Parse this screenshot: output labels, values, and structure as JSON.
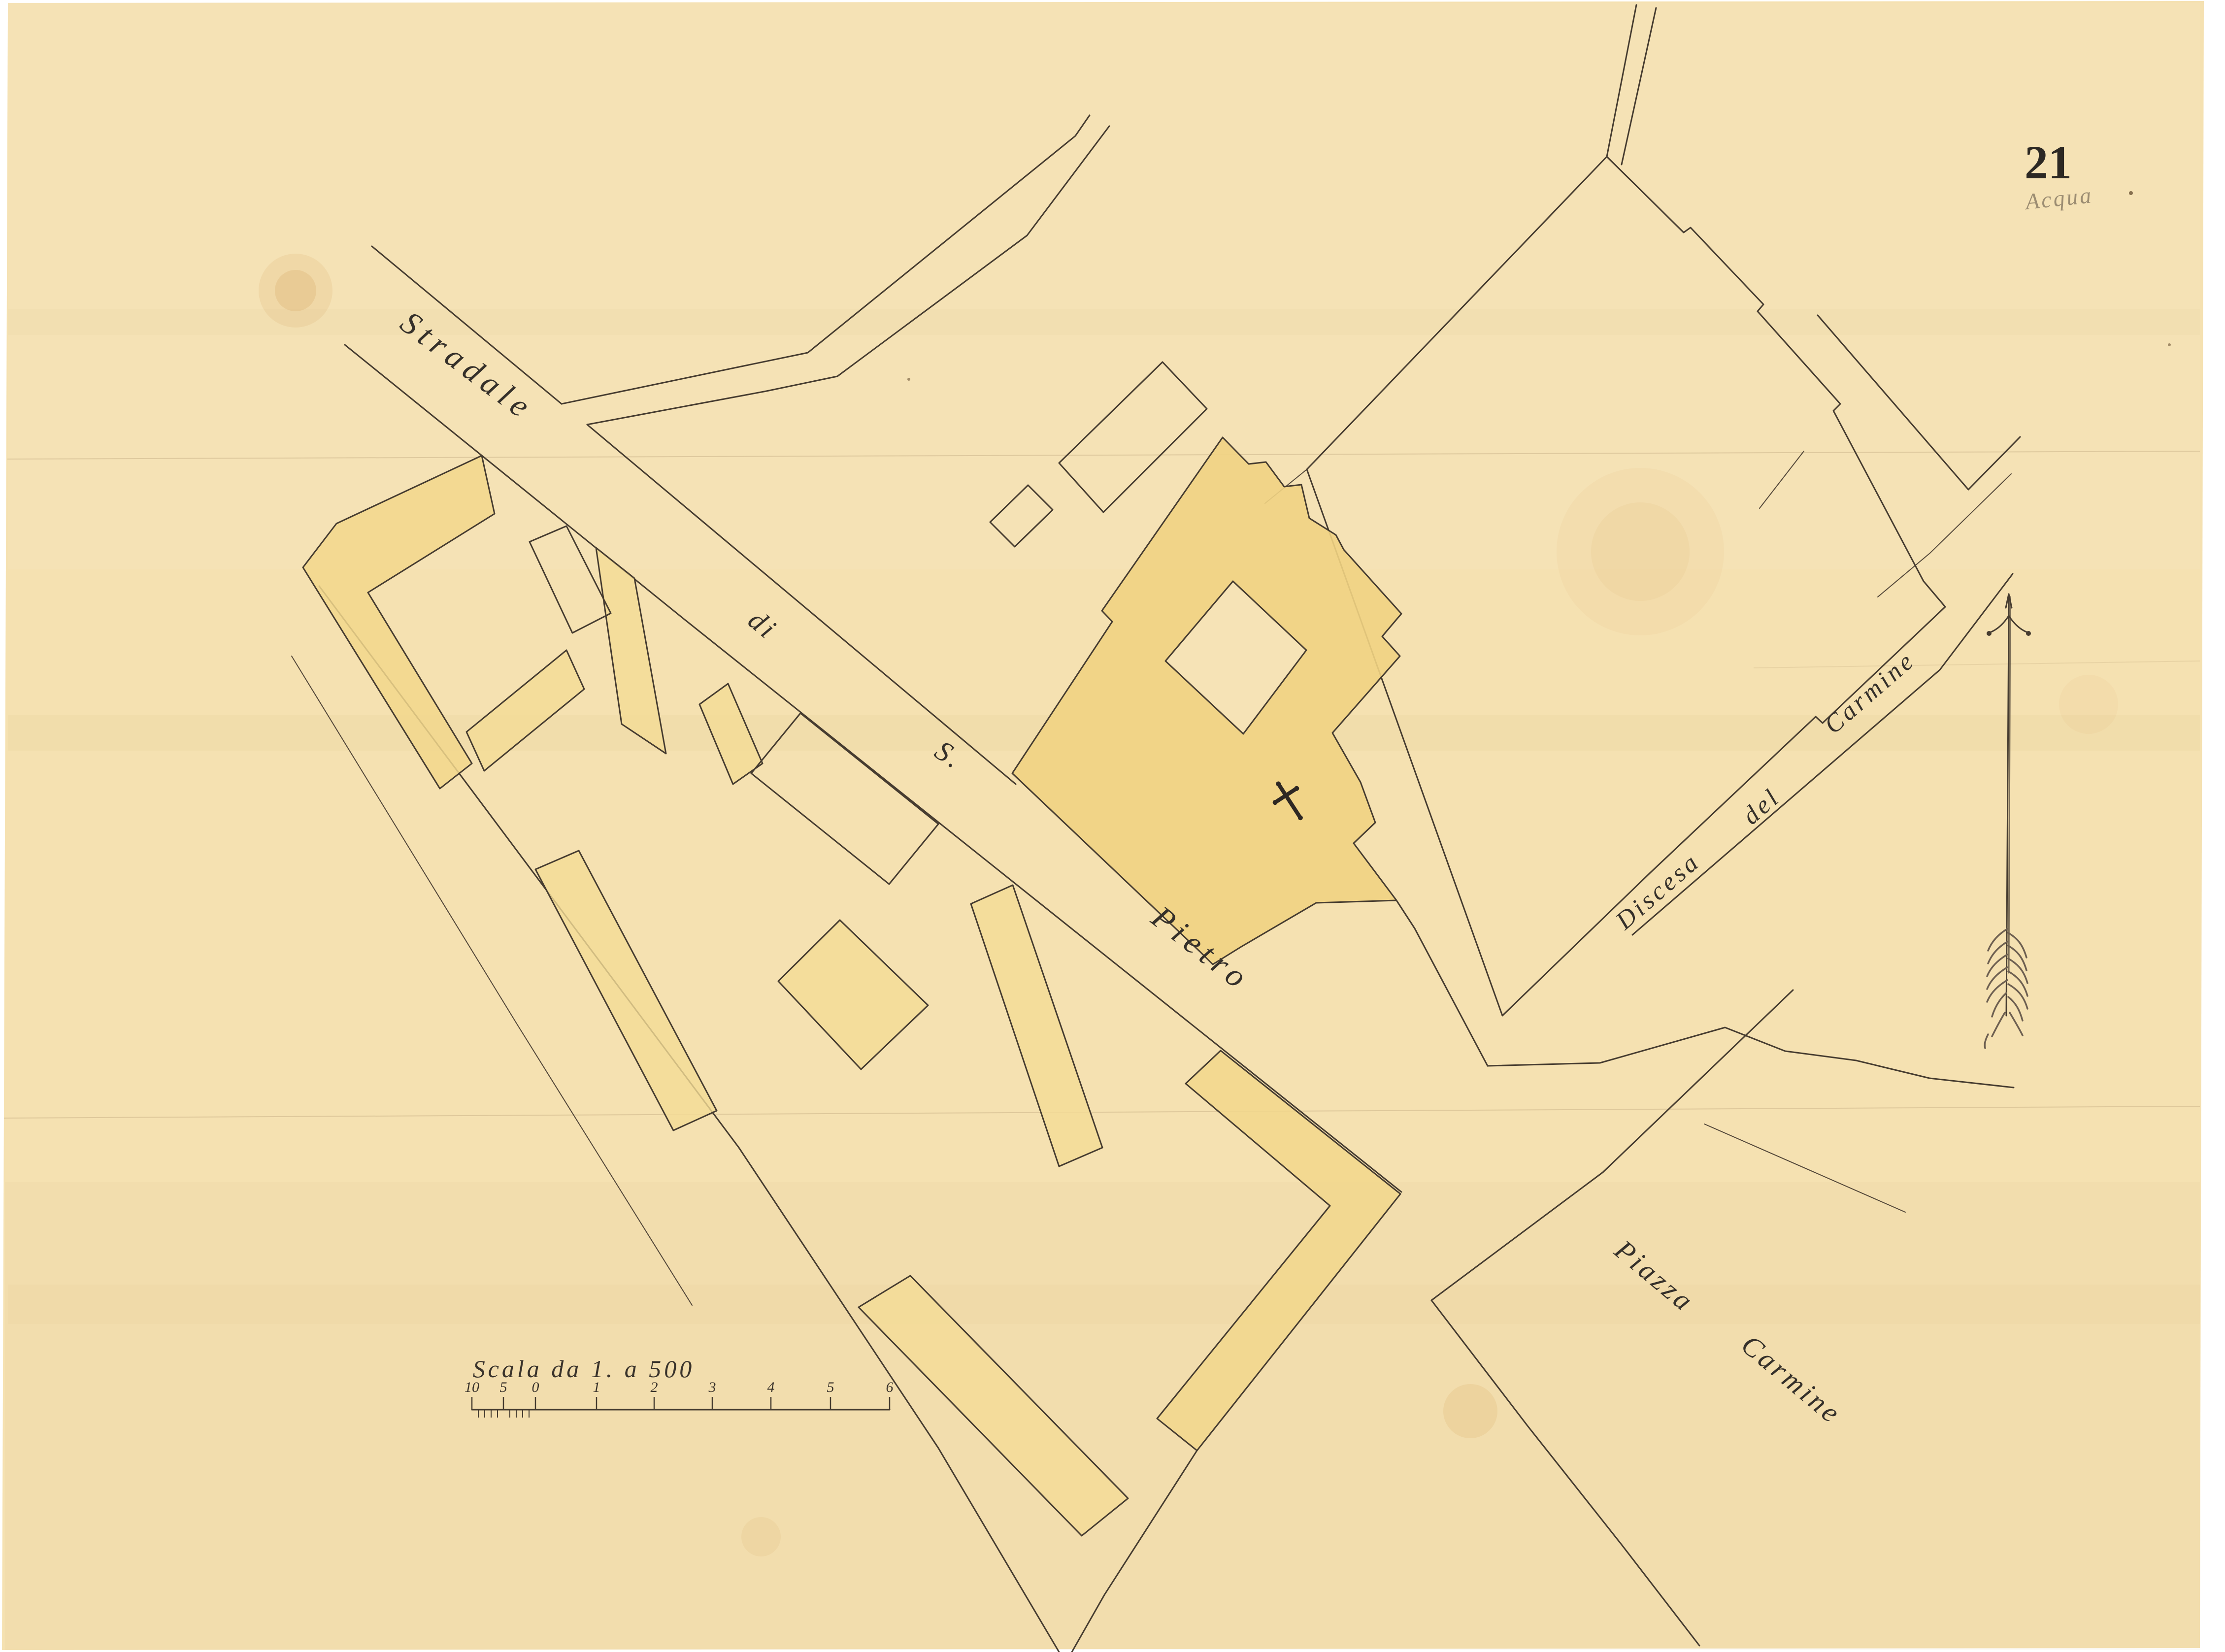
{
  "plate_number": "21",
  "pencil_note": "Acqua",
  "labels": {
    "stradale": "Stradale",
    "di": "di",
    "s": "S.",
    "pietro": "Pietro",
    "discesa": "Discesa",
    "del": "del",
    "carmine_street": "Carmine",
    "piazza": "Piazza",
    "carmine_piazza": "Carmine"
  },
  "scale": {
    "title": "Scala da 1. a 500",
    "ticks": [
      "10",
      "5",
      "0",
      "1",
      "2",
      "3",
      "4",
      "5",
      "6"
    ]
  },
  "symbols": {
    "north_arrow": "north-arrow",
    "church_cross": "latin-cross"
  },
  "colors": {
    "background": "#ffffff",
    "paper": "#f5e1b1",
    "ink": "#463c30",
    "wash": "#f2d78c",
    "wash_dark": "#eecf7e",
    "pencil": "#9c8d72"
  }
}
